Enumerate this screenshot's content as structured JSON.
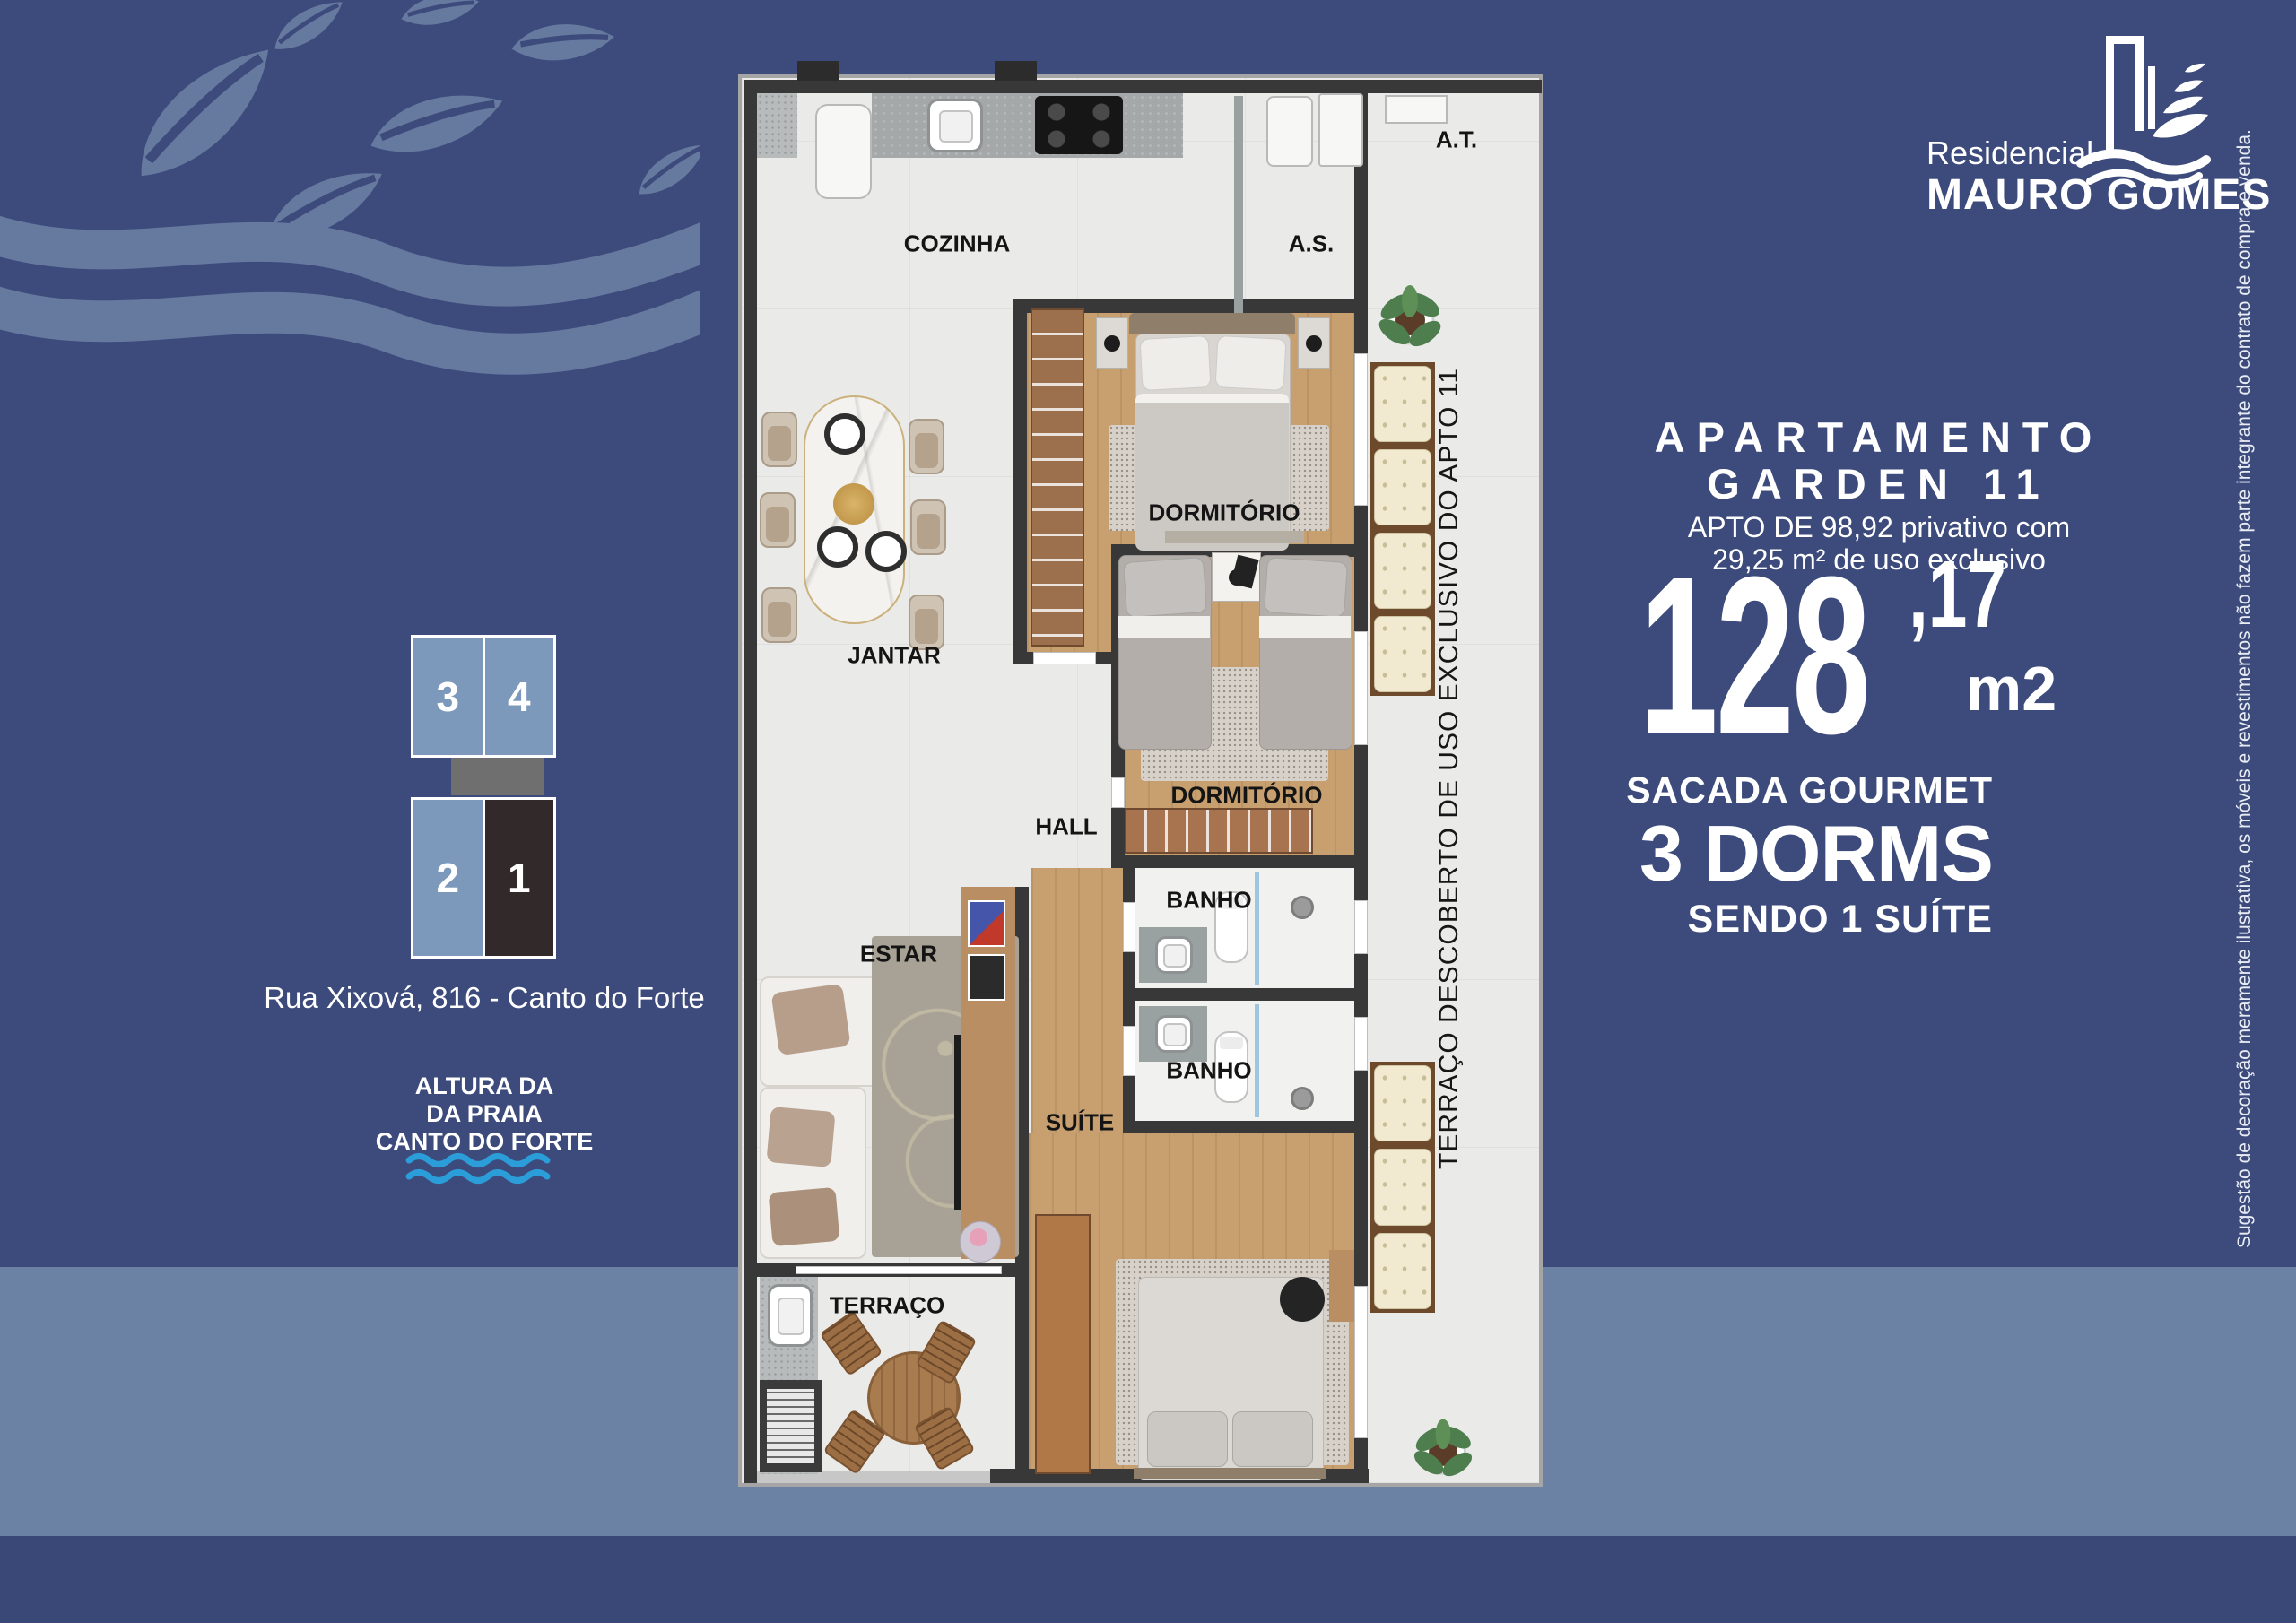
{
  "brand": {
    "prefix": "Residencial",
    "name": "MAURO GOMES"
  },
  "apartment": {
    "title_line1": "APARTAMENTO",
    "title_line2": "GARDEN 11",
    "desc_line1": "APTO DE 98,92 privativo com",
    "desc_line2": "29,25 m²  de uso exclusivo",
    "area_int": "128",
    "area_dec": ",17",
    "area_unit": "m2",
    "features": {
      "f1": "SACADA GOURMET",
      "f2": "3 DORMS",
      "f3": "SENDO 1 SUÍTE"
    }
  },
  "location": {
    "address": "Rua Xixová, 816 -  Canto do Forte",
    "landmark1": "ALTURA DA",
    "landmark2": "DA PRAIA",
    "landmark3": "CANTO DO FORTE",
    "units": {
      "u3": "3",
      "u4": "4",
      "u2": "2",
      "u1": "1"
    }
  },
  "plan": {
    "rooms": {
      "cozinha": "COZINHA",
      "as": "A.S.",
      "at": "A.T.",
      "dorm1": "DORMITÓRIO",
      "jantar": "JANTAR",
      "dorm2": "DORMITÓRIO",
      "hall": "HALL",
      "banho1": "BANHO",
      "banho2": "BANHO",
      "estar": "ESTAR",
      "suite": "SUÍTE",
      "terraco": "TERRAÇO"
    },
    "terrace_note": "TERRAÇO DESCOBERTO DE USO EXCLUSIVO DO APTO 11"
  },
  "disclaimer": "Sugestão de decoração meramente ilustrativa, os móveis e revestimentos não fazem parte integrante do contrato de compra e venda.",
  "colors": {
    "background": "#3d4b7c",
    "band": "#6b82a4",
    "footer": "#3a4877",
    "watermark": "#66799f",
    "unit_light": "#7c98ba",
    "unit_dark": "#32292b",
    "wave_blue": "#2b9dd9",
    "wall": "#383838",
    "floor": "#eaeae9"
  }
}
